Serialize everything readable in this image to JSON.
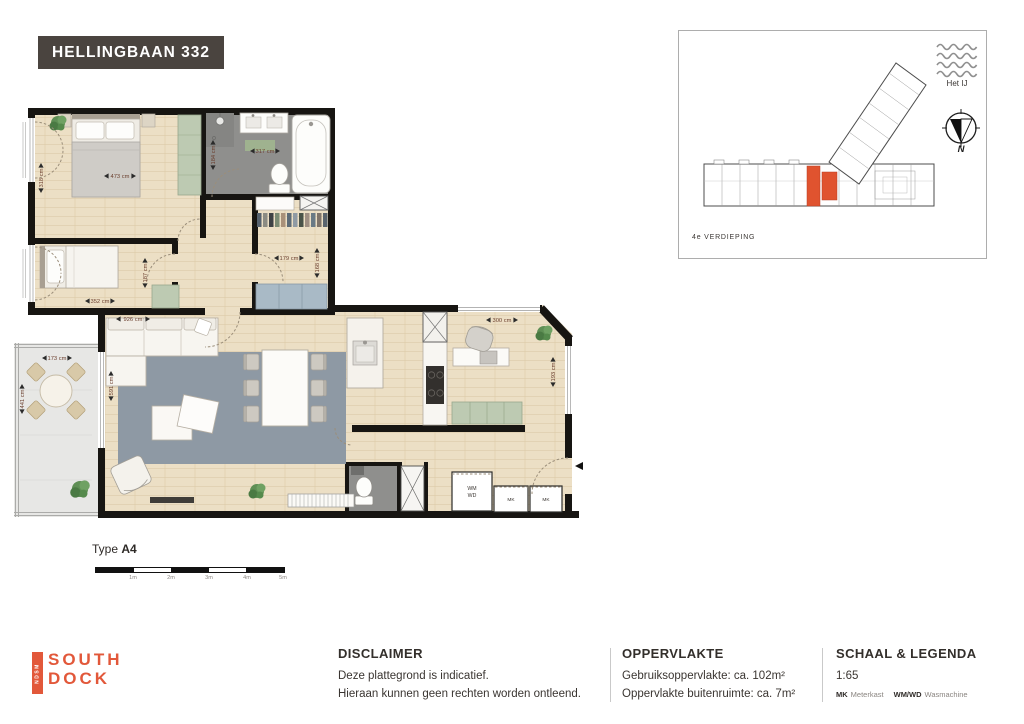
{
  "header": {
    "title": "HELLINGBAAN 332"
  },
  "site_plan": {
    "water_label": "Het IJ",
    "compass_label": "N",
    "floor_label": "4e VERDIEPING",
    "highlight_color": "#e0532f"
  },
  "plan": {
    "type_prefix": "Type",
    "type_value": "A4",
    "dims": {
      "master_w": "473 cm",
      "master_h": "318 cm",
      "bath_w": "317 cm",
      "bath_h": "184 cm",
      "bedroom2_w": "352 cm",
      "bedroom2_h": "187 cm",
      "closet_w": "179 cm",
      "closet_h": "168 cm",
      "living_w": "926 cm",
      "living_h": "591 cm",
      "office_w": "300 cm",
      "office_h": "193 cm",
      "balcony_w": "173 cm",
      "balcony_h": "441 cm"
    },
    "labels": {
      "wm": "WM",
      "wd": "WD",
      "mk1": "MK",
      "mk2": "MK"
    },
    "scale_bar": {
      "labels": [
        "1m",
        "2m",
        "3m",
        "4m",
        "5m"
      ]
    }
  },
  "footer": {
    "logo": {
      "ndsm": "NDSM",
      "line1": "SOUTH",
      "line2": "DOCK"
    },
    "disclaimer": {
      "heading": "DISCLAIMER",
      "line1": "Deze plattegrond is indicatief.",
      "line2": "Hieraan kunnen geen rechten worden ontleend."
    },
    "oppervlakte": {
      "heading": "OPPERVLAKTE",
      "row1_label": "Gebruiksoppervlakte:",
      "row1_value": "ca. 102m²",
      "row2_label": "Oppervlakte buitenruimte:",
      "row2_value": "ca. 7m²"
    },
    "schaal": {
      "heading": "SCHAAL & LEGENDA",
      "scale": "1:65",
      "legend": [
        {
          "abbr": "MK",
          "label": "Meterkast"
        },
        {
          "abbr": "WM/WD",
          "label": "Wasmachine"
        }
      ]
    }
  }
}
